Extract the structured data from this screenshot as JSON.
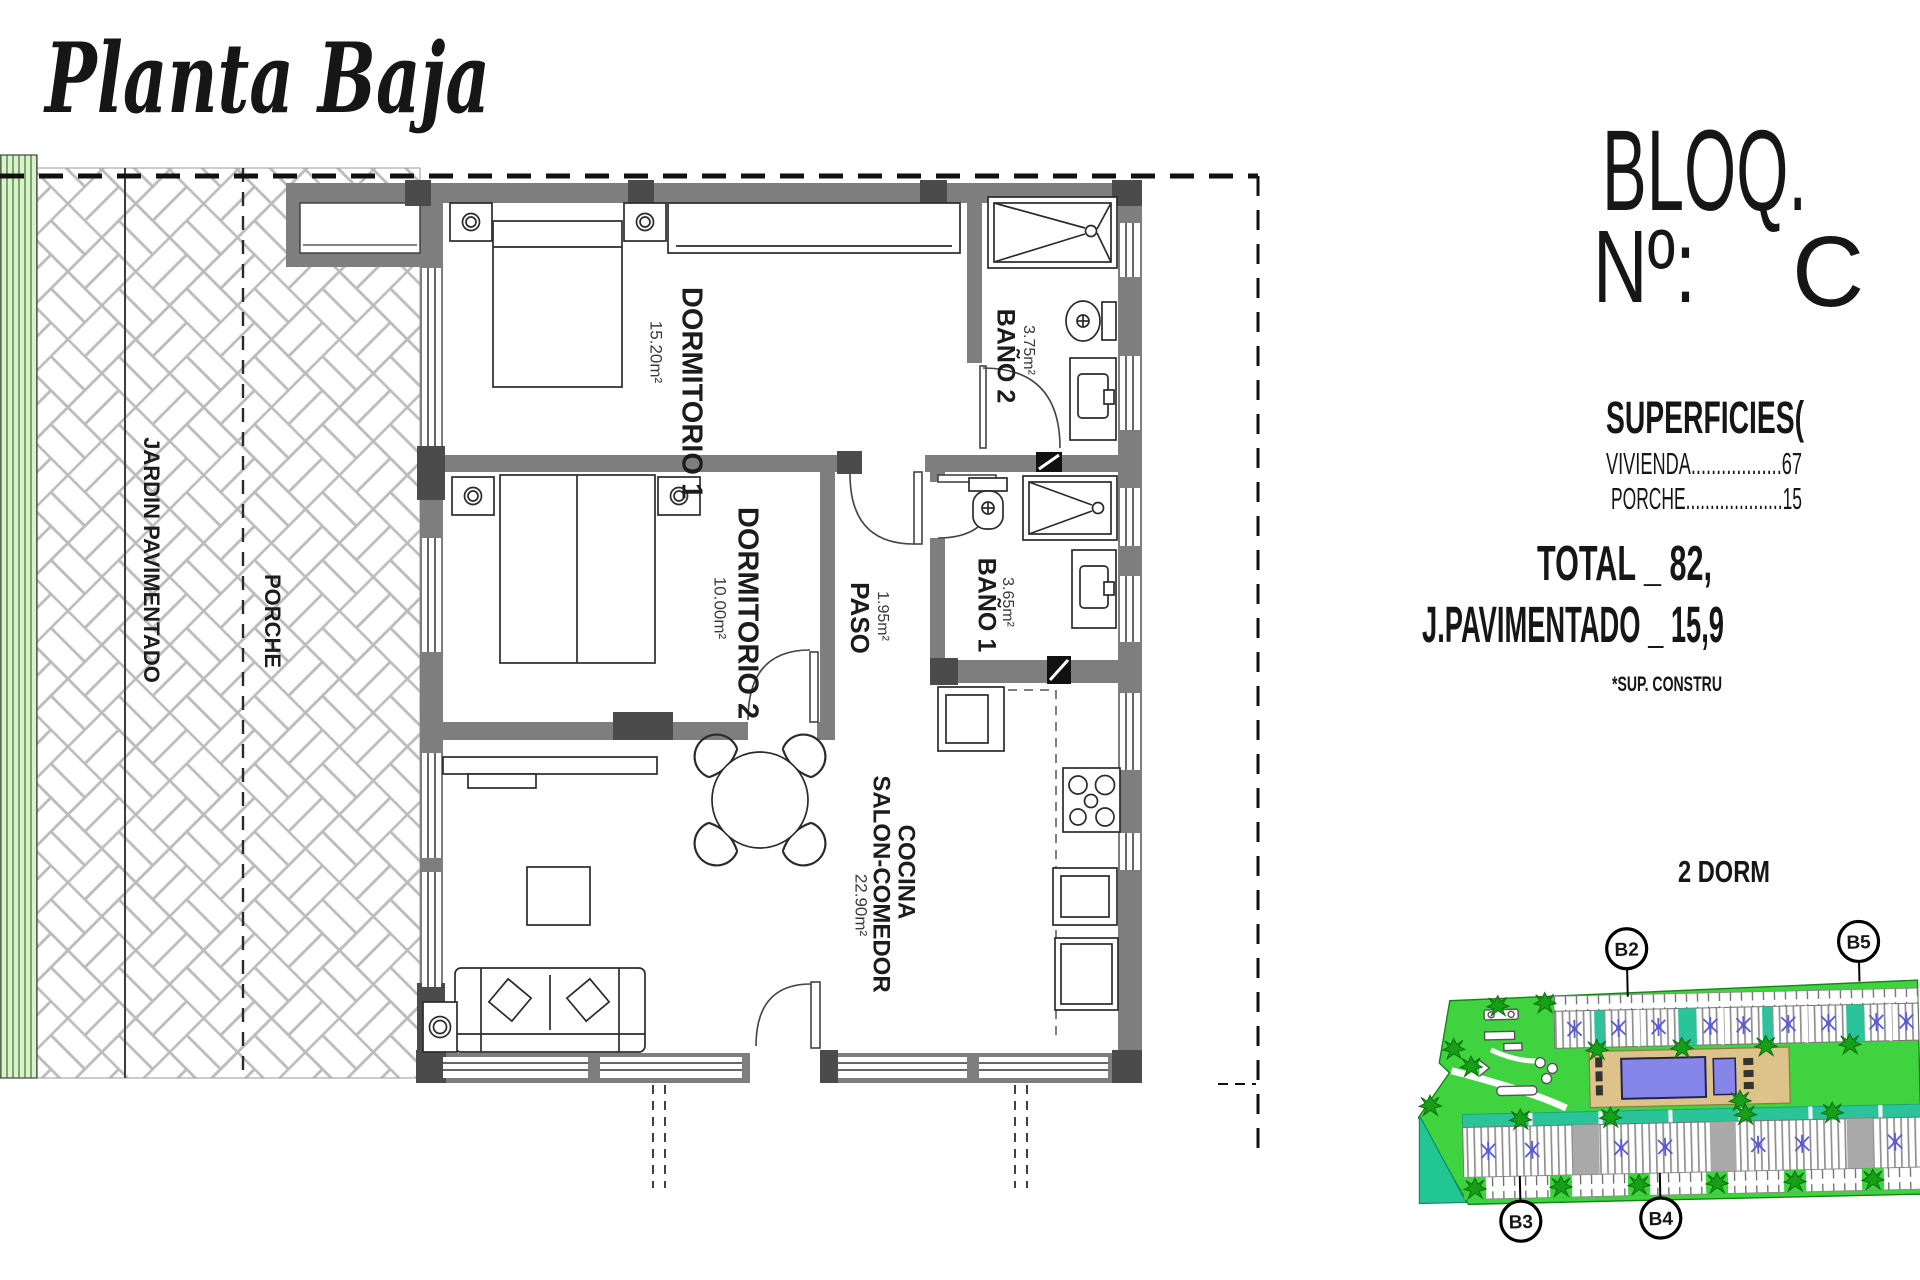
{
  "title": "Planta Baja",
  "info_panel": {
    "block_label": "BLOQ.",
    "number_label": "Nº:",
    "number_value": "C",
    "superficies_heading": "SUPERFICIES(",
    "vivienda_line": "VIVIENDA..................67",
    "porche_line": "PORCHE....................15",
    "total_line": "TOTAL _ 82,",
    "j_pavimentado_line": "J.PAVIMENTADO _ 15,9",
    "sup_construida_note": "*SUP. CONSTRU",
    "typology_note": "2 DORM"
  },
  "floor_plan": {
    "rooms": [
      {
        "name": "DORMITORIO 1",
        "area": "15.20m²"
      },
      {
        "name": "DORMITORIO 2",
        "area": "10.00m²"
      },
      {
        "name": "PASO",
        "area": "1.95m²"
      },
      {
        "name": "BAÑO 1",
        "area": "3.65m²"
      },
      {
        "name": "BAÑO 2",
        "area": "3.75m²"
      },
      {
        "name": "COCINA",
        "name2": "SALON-COMEDOR",
        "area": "22.90m²"
      }
    ],
    "outdoor_labels": [
      {
        "name": "JARDIN PAVIMENTADO"
      },
      {
        "name": "PORCHE"
      }
    ]
  },
  "site_plan": {
    "block_labels": [
      "B2",
      "B5",
      "B3",
      "B4"
    ]
  }
}
